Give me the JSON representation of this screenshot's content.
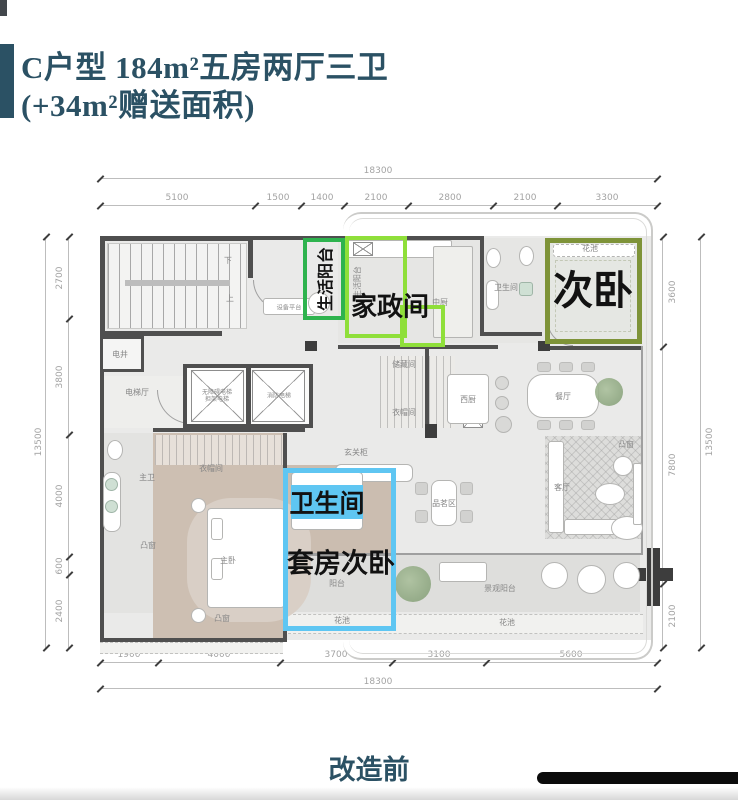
{
  "header": {
    "title_line1": "C户型 184m²五房两厅三卫",
    "title_line2": "(+34m²赠送面积)",
    "accent_color": "#2b5164"
  },
  "dimensions": {
    "top": {
      "total": "18300",
      "segments": [
        "5100",
        "1500",
        "1400",
        "2100",
        "2800",
        "2100",
        "3300"
      ]
    },
    "bottom": {
      "total": "18300",
      "segments": [
        "1900",
        "4000",
        "3700",
        "3100",
        "5600"
      ]
    },
    "left": {
      "total": "13500",
      "segments": [
        "2700",
        "3800",
        "4000",
        "600",
        "2400"
      ]
    },
    "right": {
      "total": "13500",
      "segments": [
        "3600",
        "7800",
        "2100"
      ]
    }
  },
  "plan": {
    "highlights": {
      "living_balcony": {
        "label": "生活阳台",
        "color": "#2eb34e"
      },
      "housekeeping_room": {
        "label": "家政间",
        "color": "#8fdf3a"
      },
      "secondary_bedroom": {
        "label": "次卧",
        "color": "#7e9338"
      },
      "suite_bathroom": {
        "label": "卫生间",
        "color": "#5fc6f2"
      },
      "suite_bedroom": {
        "label": "套房次卧",
        "color": "#5fc6f2"
      }
    },
    "labels": [
      "设备平台",
      "电井",
      "下",
      "上",
      "无障碍电梯",
      "担架电梯",
      "消防电梯",
      "电梯厅",
      "储藏间",
      "衣帽间",
      "中厨",
      "卫生间",
      "西厨",
      "餐厅",
      "凸窗",
      "玄关柜",
      "品茗区",
      "客厅",
      "主卫",
      "衣帽间",
      "主卧",
      "凸窗",
      "凸窗",
      "阳台",
      "花池",
      "景观阳台",
      "花池",
      "花池",
      "生活阳台"
    ]
  },
  "footer": {
    "caption": "改造前"
  }
}
